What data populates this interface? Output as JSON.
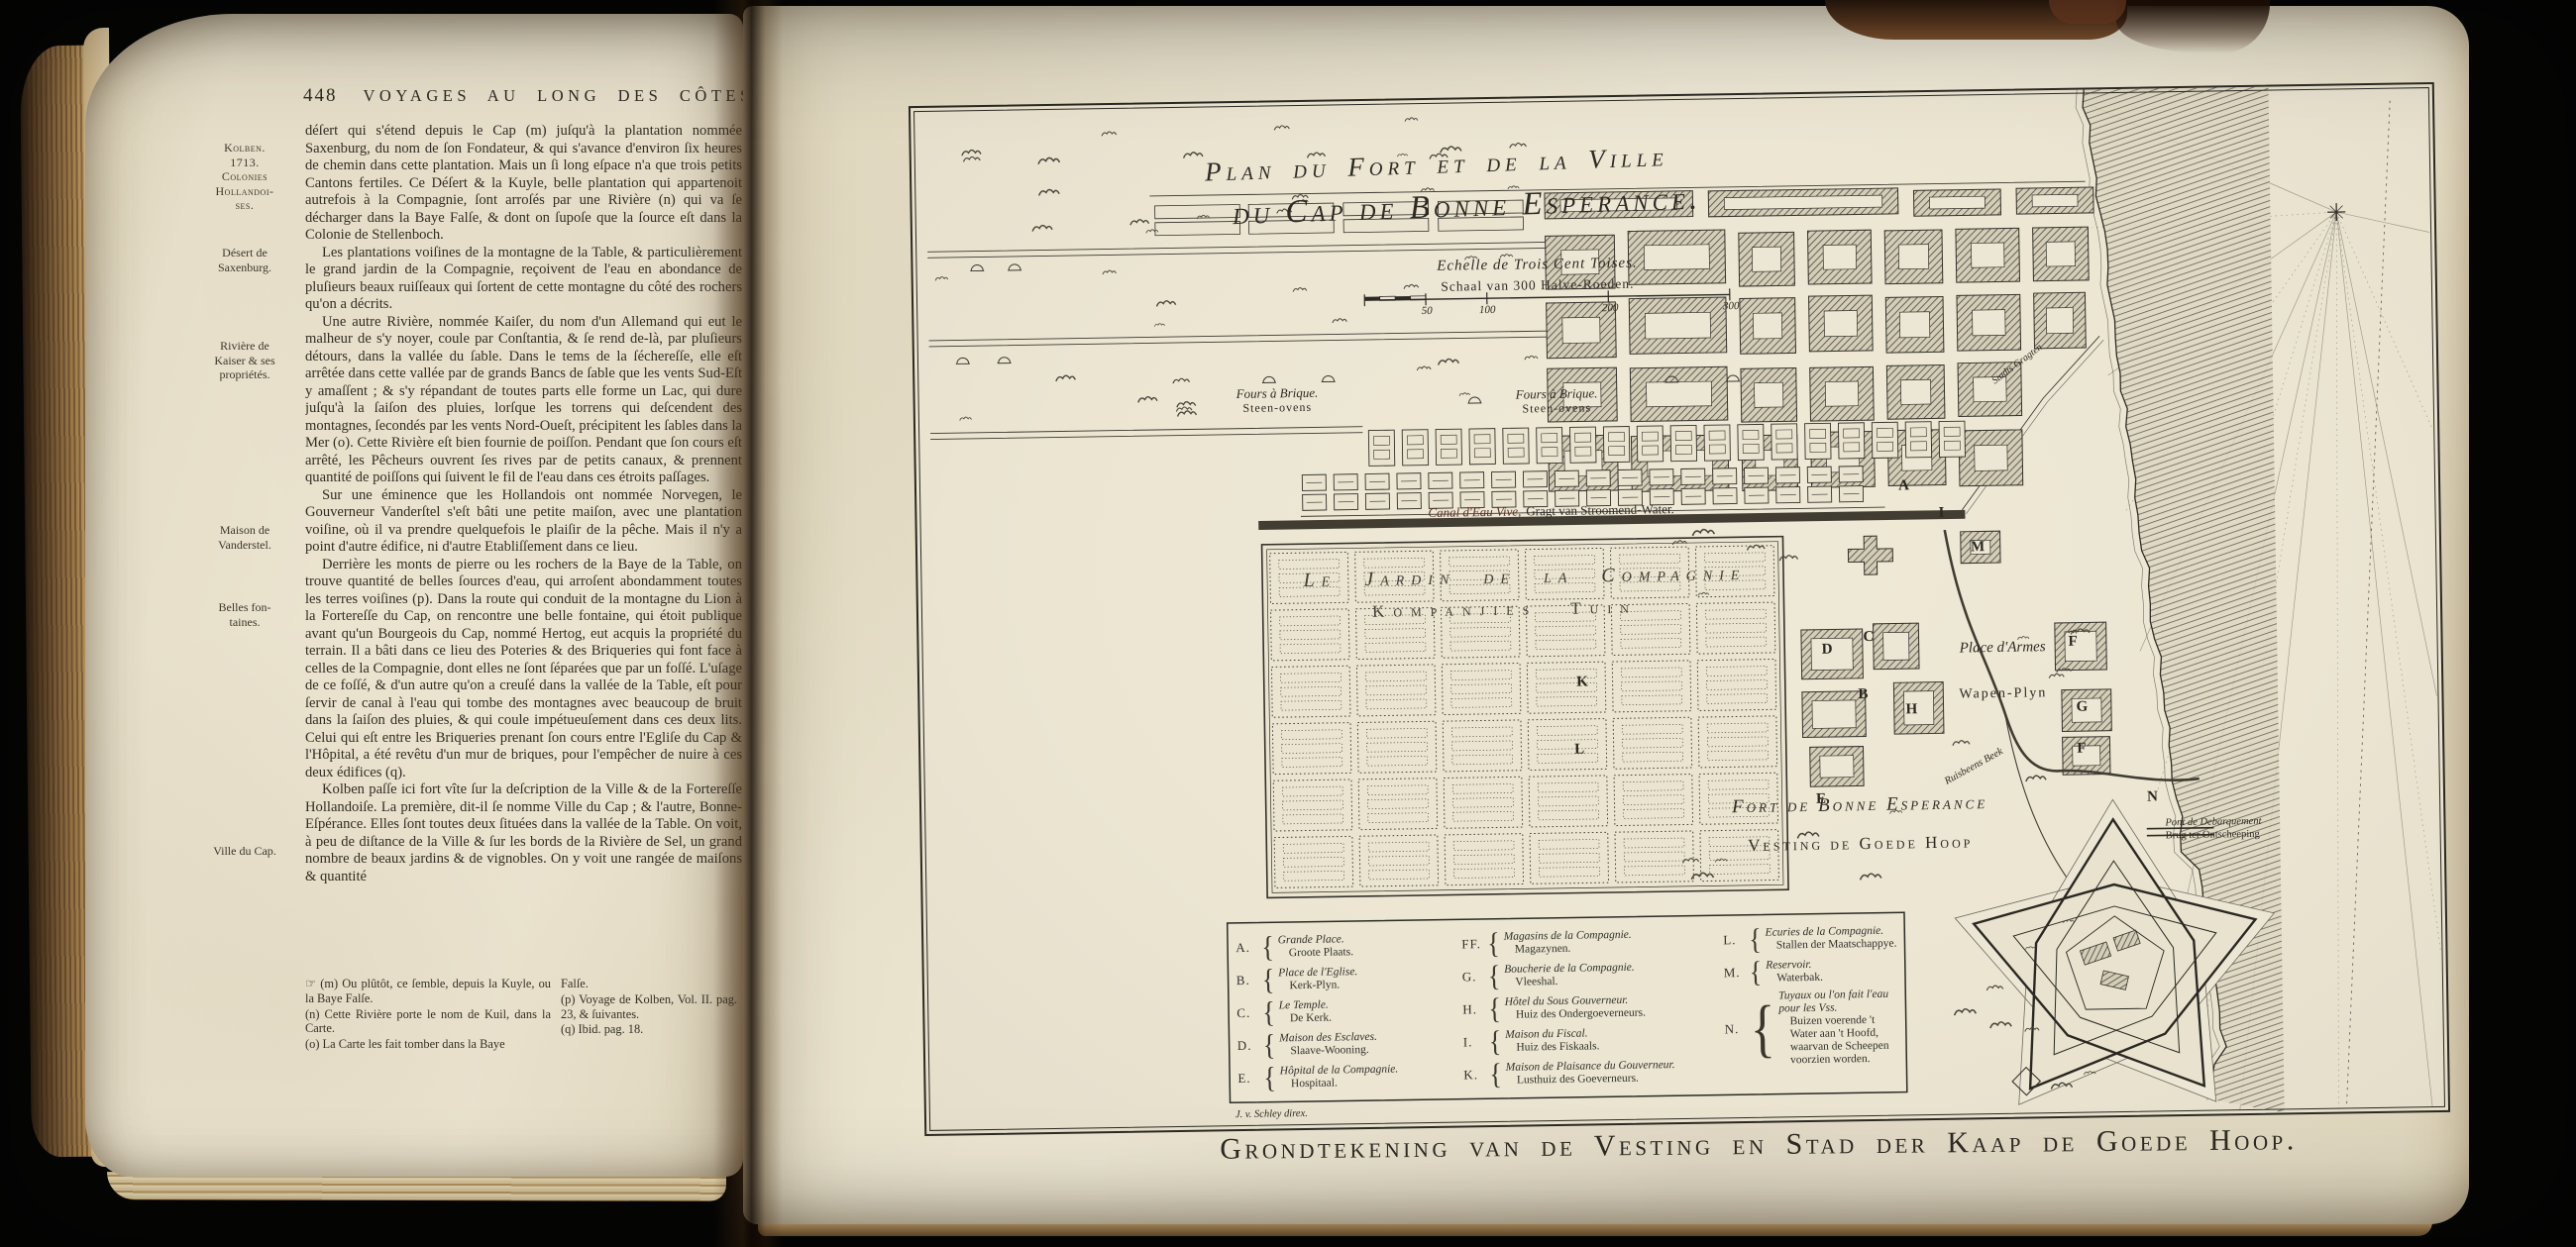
{
  "book": {
    "left_page": {
      "page_number": "448",
      "running_title": "VOYAGES AU LONG DES CÔTES",
      "margin_notes": [
        "Kolben.\n1713.\nColonies\nHollandoi-\nses.",
        "Désert de\nSaxenburg.",
        "Rivière de\nKaiser & ses\npropriétés.",
        "Maison de\nVanderstel.",
        "Belles fon-\ntaines.",
        "Ville du Cap."
      ],
      "paragraphs": [
        "déſert qui s'étend depuis le Cap (m) juſqu'à la plantation nommée Saxenburg, du nom de ſon Fondateur, & qui s'avance d'environ ſix heures de chemin dans cette plantation. Mais un ſi long eſpace n'a que trois petits Cantons fertiles. Ce Déſert & la Kuyle, belle plantation qui appartenoit autrefois à la Compagnie, ſont arroſés par une Rivière (n) qui va ſe décharger dans la Baye Falſe, & dont on ſupoſe que la ſource eſt dans la Colonie de Stellenboch.",
        "Les plantations voiſines de la montagne de la Table, & particulièrement le grand jardin de la Compagnie, reçoivent de l'eau en abondance de pluſieurs beaux ruiſſeaux qui ſortent de cette montagne du côté des rochers qu'on a décrits.",
        "Une autre Rivière, nommée Kaiſer, du nom d'un Allemand qui eut le malheur de s'y noyer, coule par Conſtantia, & ſe rend de-là, par pluſieurs détours, dans la vallée du ſable. Dans le tems de la ſéchereſſe, elle eſt arrêtée dans cette vallée par de grands Bancs de ſable que les vents Sud-Eſt y amaſſent ; & s'y répandant de toutes parts elle forme un Lac, qui dure juſqu'à la ſaiſon des pluies, lorſque les torrens qui deſcendent des montagnes, ſecondés par les vents Nord-Oueſt, précipitent les ſables dans la Mer (o). Cette Rivière eſt bien fournie de poiſſon. Pendant que ſon cours eſt arrêté, les Pêcheurs ouvrent ſes rives par de petits canaux, & prennent quantité de poiſſons qui ſuivent le fil de l'eau dans ces étroits paſſages.",
        "Sur une éminence que les Hollandois ont nommée Norvegen, le Gouverneur Vanderſtel s'eſt bâti une petite maiſon, avec une plantation voiſine, où il va prendre quelquefois le plaiſir de la pêche. Mais il n'y a point d'autre édifice, ni d'autre Etabliſſement dans ce lieu.",
        "Derrière les monts de pierre ou les rochers de la Baye de la Table, on trouve quantité de belles ſources d'eau, qui arroſent abondamment toutes les terres voiſines (p). Dans la route qui conduit de la montagne du Lion à la Fortereſſe du Cap, on rencontre une belle fontaine, qui étoit publique avant qu'un Bourgeois du Cap, nommé Hertog, eut acquis la propriété du terrain. Il a bâti dans ce lieu des Poteries & des Briqueries qui font face à celles de la Compagnie, dont elles ne ſont ſéparées que par un foſſé. L'uſage de ce foſſé, & d'un autre qu'on a creuſé dans la vallée de la Table, eſt pour ſervir de canal à l'eau qui tombe des montagnes avec beaucoup de bruit dans la ſaiſon des pluies, & qui coule impétueuſement dans ces deux lits. Celui qui eſt entre les Briqueries prenant ſon cours entre l'Egliſe du Cap & l'Hôpital, a été revêtu d'un mur de briques, pour l'empêcher de nuire à ces deux édifices (q).",
        "Kolben paſſe ici fort vîte ſur la deſcription de la Ville & de la Fortereſſe Hollandoiſe. La première, dit-il ſe nomme Ville du Cap ; & l'autre, Bonne-Eſpérance. Elles ſont toutes deux ſituées dans la vallée de la Table. On voit, à peu de diſtance de la Ville & ſur les bords de la Rivière de Sel, un grand nombre de beaux jardins & de vignobles. On y voit une rangée de maiſons & quantité"
      ],
      "footnotes_left": [
        "☞ (m) Ou plûtôt, ce ſemble, depuis la Kuyle, ou la Baye Falſe.",
        "(n) Cette Rivière porte le nom de Kuil, dans la Carte.",
        "(o) La Carte les fait tomber dans la Baye"
      ],
      "footnotes_right": [
        "Falſe.",
        "(p) Voyage de Kolben, Vol. II. pag. 23, & ſuivantes.",
        "(q) Ibid. pag. 18."
      ]
    },
    "map": {
      "title_line1": "Plan du Fort et de la Ville",
      "title_line2": "du Cap de Bonne Esperance.",
      "scale_fr": "Echelle de Trois Cent Toises.",
      "scale_nl": "Schaal van 300 Halve-Roeden.",
      "scale_ticks": [
        "50",
        "100",
        "200",
        "300"
      ],
      "fours_fr": "Fours à Brique.",
      "fours_nl": "Steen-ovens",
      "canal_fr": "Canal d'Eau Vive,",
      "canal_nl": "Gragt van Stroomend-Water.",
      "garden_fr": "Le Jardin de la Compagnie",
      "garden_nl": "Kompanjies Tuin",
      "stadts_label": "Stadts Gragten",
      "place_armes_fr": "Place d'Armes",
      "place_armes_nl": "Wapen-Plyn",
      "fort_fr": "Fort de Bonne Esperance",
      "fort_nl": "Vesting de Goede Hoop",
      "river_label": "Ruisbeens Beek",
      "pont_fr": "Pont de Debarquement",
      "pont_nl": "Brug ter Ontscheeping",
      "engraver": "J. v. Schley direx.",
      "plan_letters": [
        "A",
        "I",
        "D",
        "C",
        "B",
        "H",
        "F",
        "G",
        "F",
        "K",
        "L",
        "M",
        "E",
        "N"
      ],
      "legend": {
        "col1": [
          {
            "key": "A.",
            "fr": "Grande Place.",
            "nl": "Groote Plaats."
          },
          {
            "key": "B.",
            "fr": "Place de l'Eglise.",
            "nl": "Kerk-Plyn."
          },
          {
            "key": "C.",
            "fr": "Le Temple.",
            "nl": "De Kerk."
          },
          {
            "key": "D.",
            "fr": "Maison des Esclaves.",
            "nl": "Slaave-Wooning."
          },
          {
            "key": "E.",
            "fr": "Hôpital de la Compagnie.",
            "nl": "Hospitaal."
          }
        ],
        "col2": [
          {
            "key": "FF.",
            "fr": "Magasins de la Compagnie.",
            "nl": "Magazynen."
          },
          {
            "key": "G.",
            "fr": "Boucherie de la Compagnie.",
            "nl": "Vleeshal."
          },
          {
            "key": "H.",
            "fr": "Hôtel du Sous Gouverneur.",
            "nl": "Huiz des Ondergoeverneurs."
          },
          {
            "key": "I.",
            "fr": "Maison du Fiscal.",
            "nl": "Huiz des Fiskaals."
          },
          {
            "key": "K.",
            "fr": "Maison de Plaisance du Gouverneur.",
            "nl": "Lusthuiz des Goeverneurs."
          }
        ],
        "col3": [
          {
            "key": "L.",
            "fr": "Ecuries de la Compagnie.",
            "nl": "Stallen der Maatschappye."
          },
          {
            "key": "M.",
            "fr": "Reservoir.",
            "nl": "Waterbak."
          },
          {
            "key": "N.",
            "fr": "Tuyaux ou l'on fait l'eau pour les Vss.",
            "nl": "Buizen voerende 't Water aan 't Hoofd, waarvan de Scheepen voorzien worden."
          }
        ]
      }
    },
    "bottom_title": "Grondtekening van de Vesting en Stad der Kaap de Goede Hoop."
  }
}
